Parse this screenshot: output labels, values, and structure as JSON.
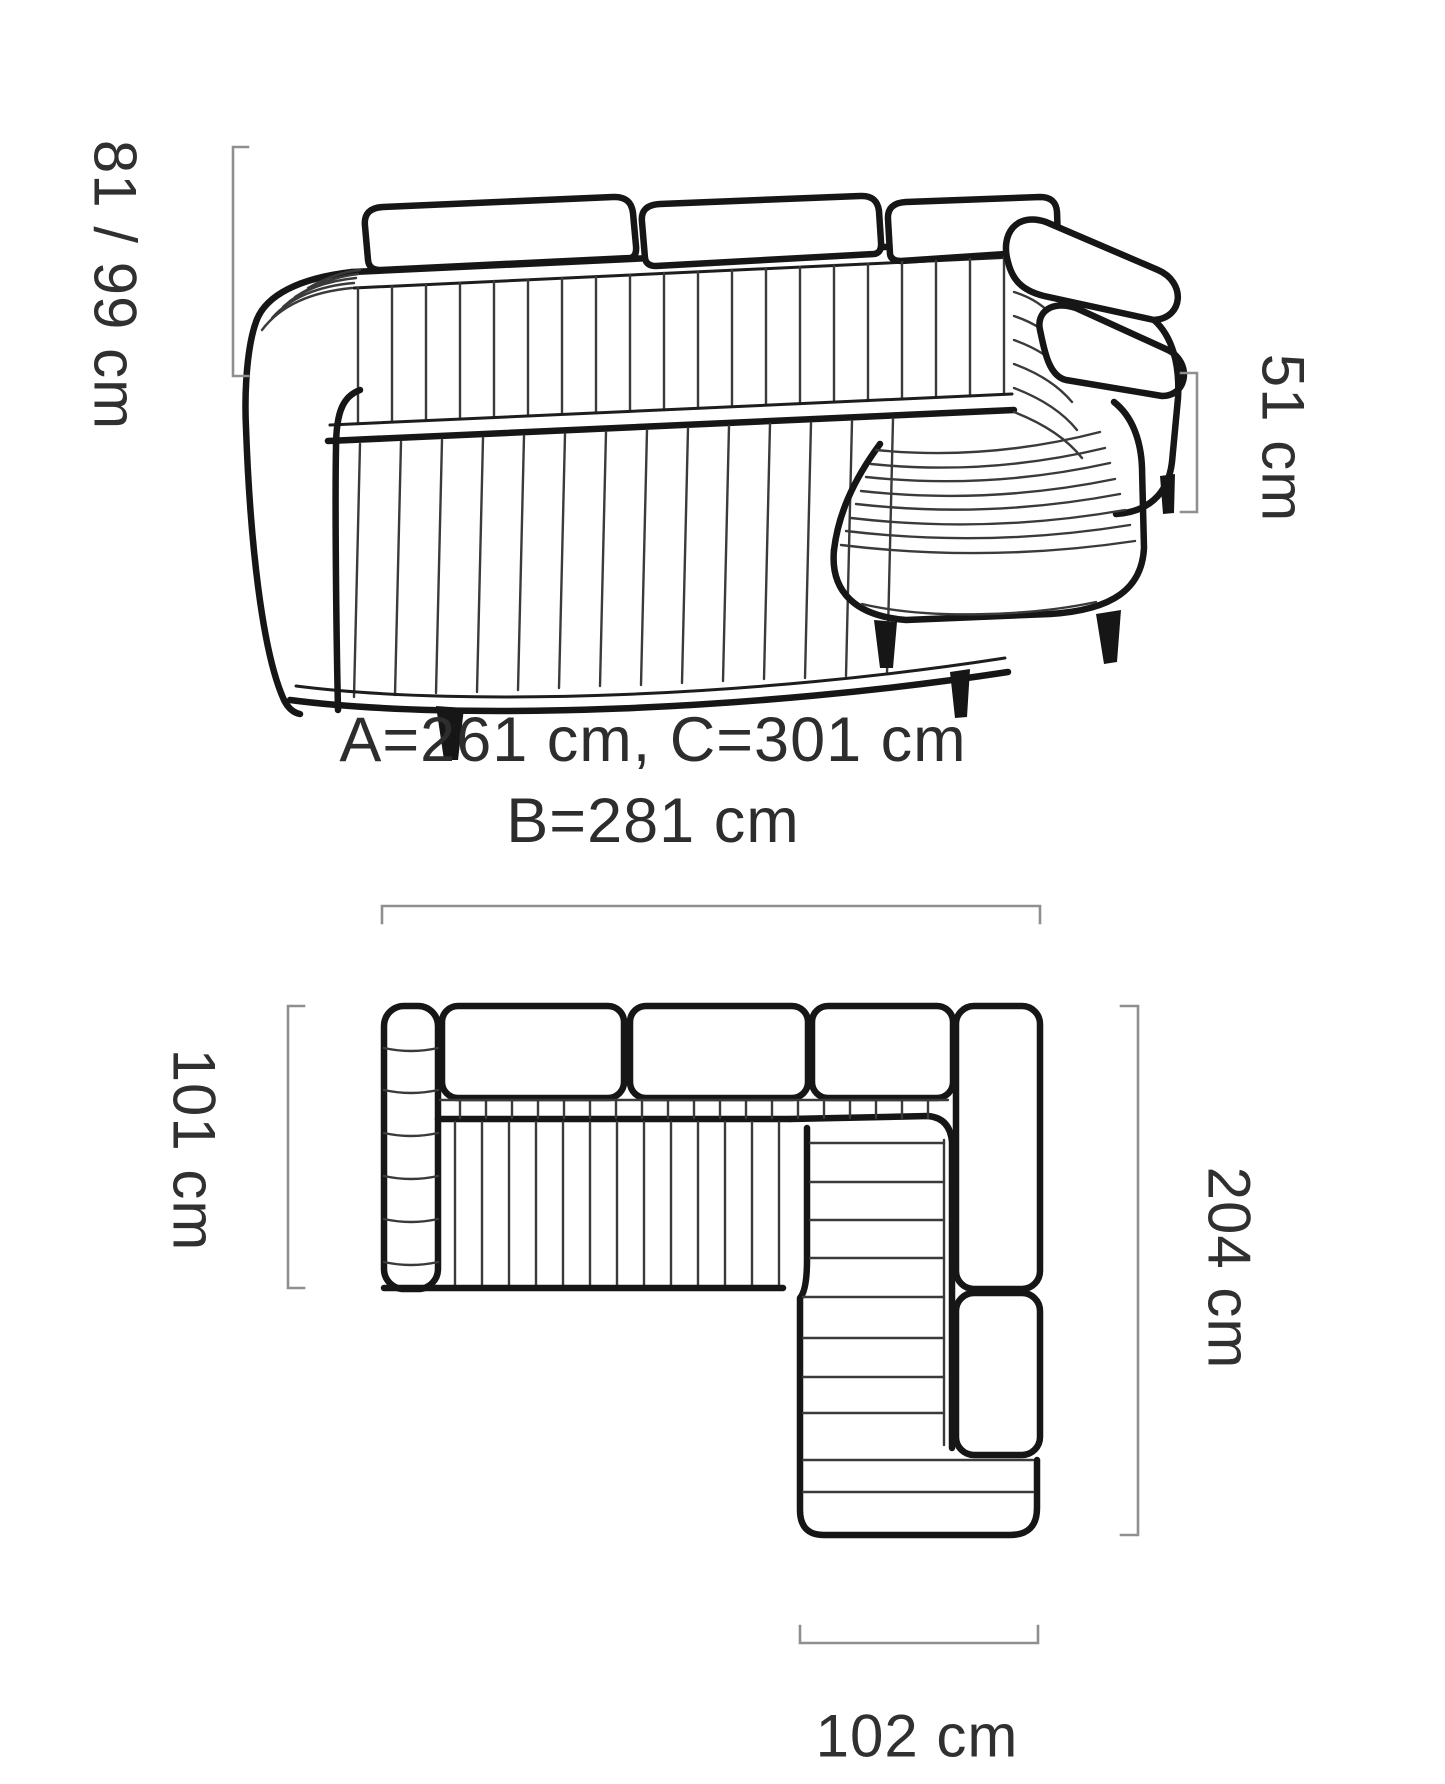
{
  "diagram": {
    "side_view": {
      "height_label": "81 / 99 cm",
      "arm_height_label": "51 cm"
    },
    "dimensions_note": {
      "line1": "A=261 cm, C=301 cm",
      "line2": "B=281 cm"
    },
    "top_view": {
      "seat_depth_label": "101 cm",
      "total_depth_label": "204 cm",
      "chaise_width_label": "102 cm"
    },
    "colors": {
      "line": "#161616",
      "measure": "#8f8f8f",
      "text": "#2d2d2d",
      "background": "#ffffff"
    }
  }
}
